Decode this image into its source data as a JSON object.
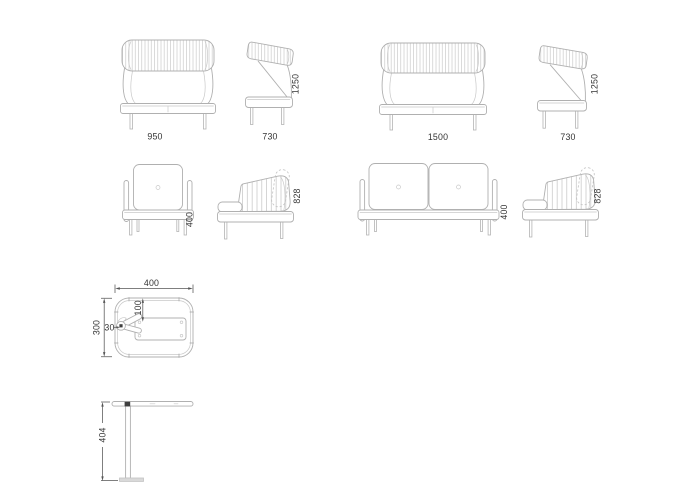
{
  "colors": {
    "background": "#ffffff",
    "line": "#b0b0b0",
    "stripe": "#c6c6c6",
    "dimension": "#555555",
    "label_text": "#333333"
  },
  "views": {
    "armchair_high_front": {
      "width": "950"
    },
    "armchair_high_side": {
      "depth": "730",
      "height": "1250"
    },
    "sofa_high_front": {
      "width": "1500"
    },
    "sofa_high_side": {
      "depth": "730",
      "height": "1250"
    },
    "armchair_low_front": {
      "seat_height": "400"
    },
    "armchair_low_side": {
      "overall_height": "828"
    },
    "sofa_low_front": {
      "seat_height": "400"
    },
    "sofa_low_side": {
      "overall_height": "828"
    },
    "table_top": {
      "width": "400",
      "depth": "300",
      "plate_offset": "100",
      "plate_inset": "30"
    },
    "table_side": {
      "height": "404"
    }
  }
}
